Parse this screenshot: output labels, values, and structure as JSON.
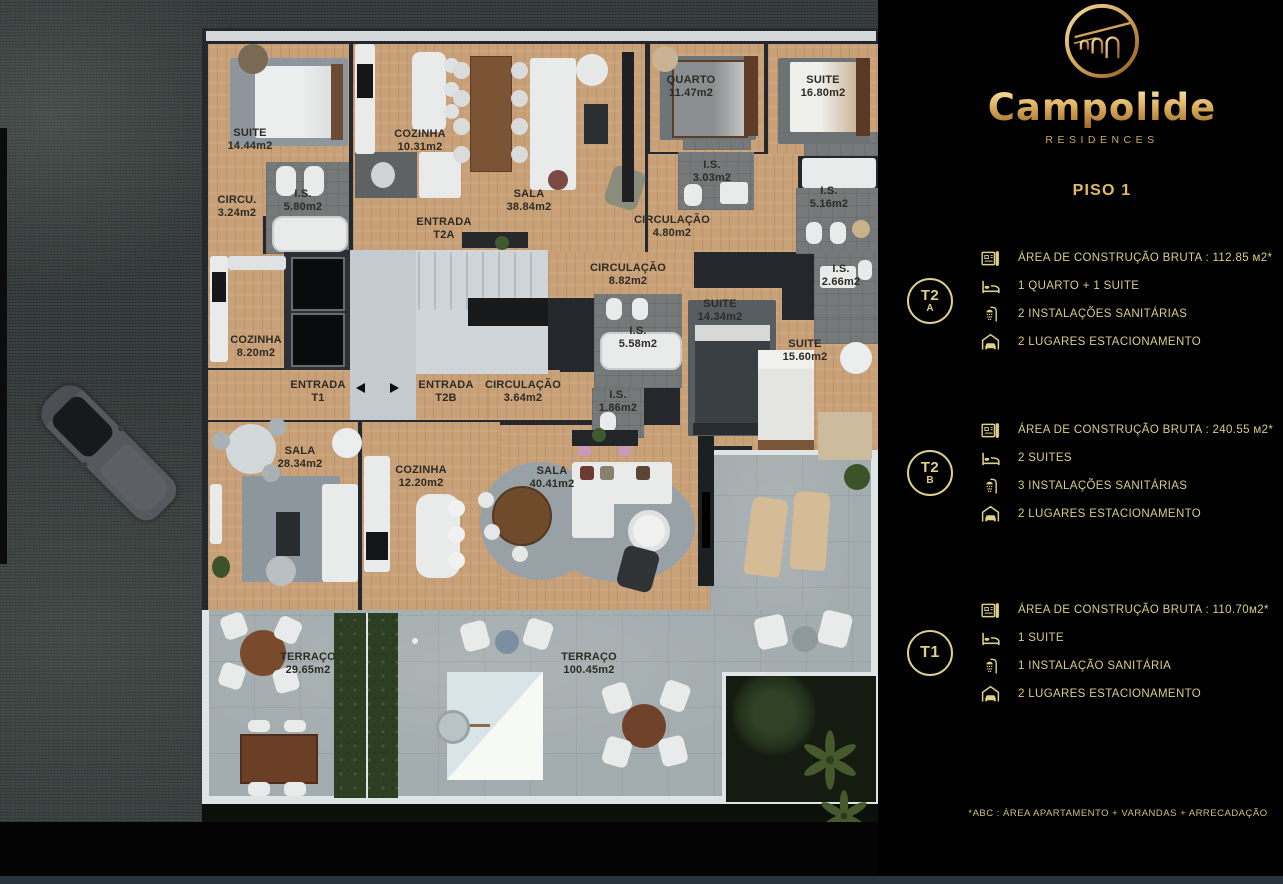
{
  "brand": {
    "name": "Campolide",
    "subtitle": "RESIDENCES",
    "logo": "aqueduct-arches-emblem"
  },
  "panel": {
    "floor_title": "PISO 1",
    "units": [
      {
        "id": "T2A",
        "badge_line1": "T2",
        "badge_line2": "A",
        "rows": [
          {
            "icon": "floorplan-icon",
            "text": "ÁREA DE CONSTRUÇÃO BRUTA :  112.85 м2*"
          },
          {
            "icon": "bed-icon",
            "text": "1 QUARTO + 1 SUITE"
          },
          {
            "icon": "shower-icon",
            "text": "2 INSTALAÇÕES SANITÁRIAS"
          },
          {
            "icon": "garage-icon",
            "text": "2 LUGARES ESTACIONAMENTO"
          }
        ]
      },
      {
        "id": "T2B",
        "badge_line1": "T2",
        "badge_line2": "B",
        "rows": [
          {
            "icon": "floorplan-icon",
            "text": "ÁREA DE CONSTRUÇÃO BRUTA :  240.55 м2*"
          },
          {
            "icon": "bed-icon",
            "text": "2 SUITES"
          },
          {
            "icon": "shower-icon",
            "text": "3 INSTALAÇÕES SANITÁRIAS"
          },
          {
            "icon": "garage-icon",
            "text": "2 LUGARES ESTACIONAMENTO"
          }
        ]
      },
      {
        "id": "T1",
        "badge_line1": "T1",
        "badge_line2": "",
        "rows": [
          {
            "icon": "floorplan-icon",
            "text": "ÁREA DE CONSTRUÇÃO BRUTA :  110.70м2*"
          },
          {
            "icon": "bed-icon",
            "text": "1 SUITE"
          },
          {
            "icon": "shower-icon",
            "text": "1 INSTALAÇÃO SANITÁRIA"
          },
          {
            "icon": "garage-icon",
            "text": "2 LUGARES ESTACIONAMENTO"
          }
        ]
      }
    ],
    "footnote": "*ABC :  ÁREA APARTAMENTO + VARANDAS + ARRECADAÇÃO"
  },
  "plan": {
    "floor": "PISO 1",
    "labels": [
      {
        "line1": "SUITE",
        "line2": "14.44m2"
      },
      {
        "line1": "COZINHA",
        "line2": "10.31m2"
      },
      {
        "line1": "SALA",
        "line2": "38.84m2"
      },
      {
        "line1": "QUARTO",
        "line2": "11.47m2"
      },
      {
        "line1": "SUITE",
        "line2": "16.80m2"
      },
      {
        "line1": "I.S.",
        "line2": "5.80m2"
      },
      {
        "line1": "CIRCU.",
        "line2": "3.24m2"
      },
      {
        "line1": "ENTRADA",
        "line2": "T2A"
      },
      {
        "line1": "CIRCULAÇÃO",
        "line2": "4.80m2"
      },
      {
        "line1": "I.S.",
        "line2": "3.03m2"
      },
      {
        "line1": "I.S.",
        "line2": "5.16m2"
      },
      {
        "line1": "CIRCULAÇÃO",
        "line2": "8.82m2"
      },
      {
        "line1": "I.S.",
        "line2": "5.58m2"
      },
      {
        "line1": "SUITE",
        "line2": "14.34m2"
      },
      {
        "line1": "I.S.",
        "line2": "2.66m2"
      },
      {
        "line1": "SUITE",
        "line2": "15.60m2"
      },
      {
        "line1": "I.S.",
        "line2": "1.86m2"
      },
      {
        "line1": "COZINHA",
        "line2": "8.20m2"
      },
      {
        "line1": "ENTRADA",
        "line2": "T1"
      },
      {
        "line1": "ENTRADA",
        "line2": "T2B"
      },
      {
        "line1": "CIRCULAÇÃO",
        "line2": "3.64m2"
      },
      {
        "line1": "SALA",
        "line2": "28.34m2"
      },
      {
        "line1": "COZINHA",
        "line2": "12.20m2"
      },
      {
        "line1": "SALA",
        "line2": "40.41m2"
      },
      {
        "line1": "TERRAÇO",
        "line2": "29.65m2"
      },
      {
        "line1": "TERRAÇO",
        "line2": "100.45m2"
      }
    ]
  },
  "colors": {
    "gold": "#dcd08c",
    "gold_bright": "#e2bb62",
    "wood": "#c9a178",
    "panel_bg": "#010102"
  }
}
